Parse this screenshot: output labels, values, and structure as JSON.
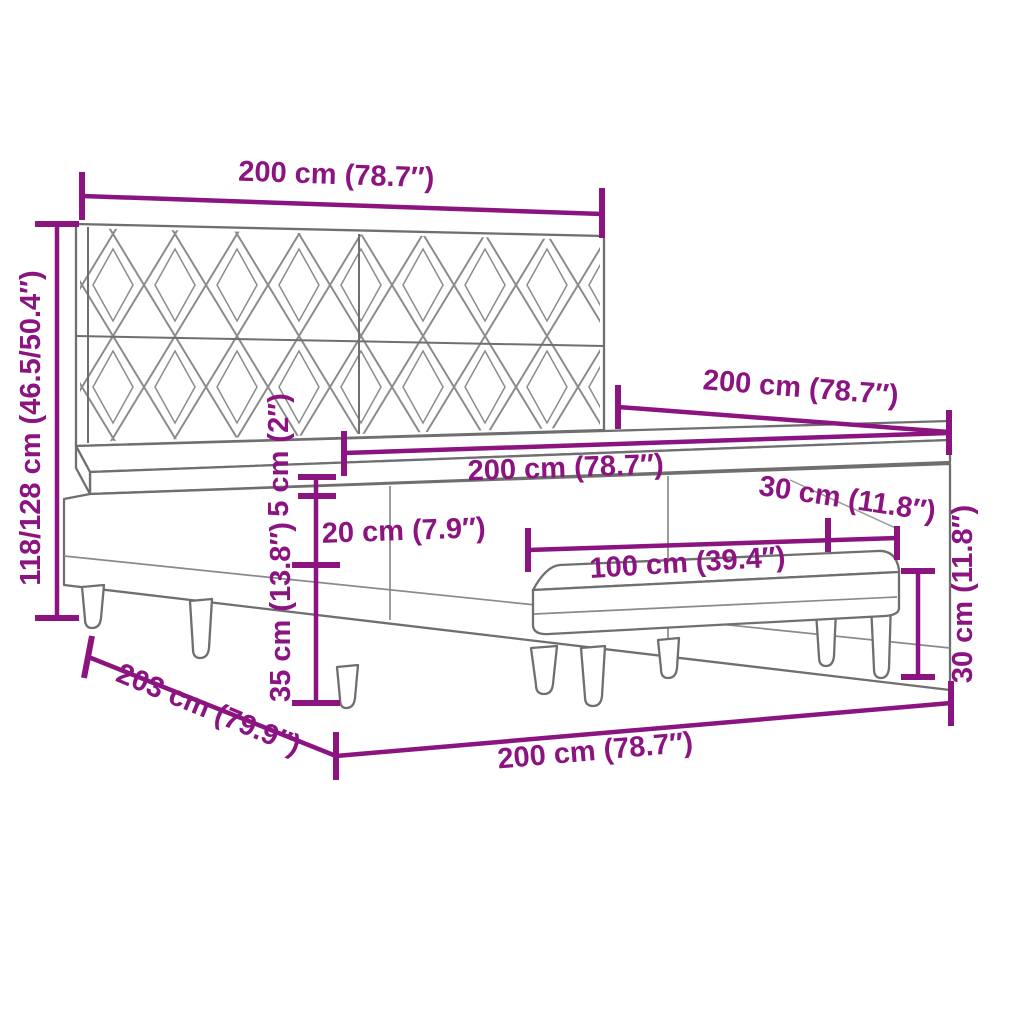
{
  "diagram": {
    "kind": "furniture-dimension-diagram",
    "subject": "box spring bed with patterned headboard and bench",
    "colors": {
      "dimension_accent": "#8B1480",
      "furniture_line": "#6F6F6F",
      "pattern_line": "#8B8B8B",
      "background": "#FFFFFF"
    },
    "dims": {
      "headboard_width": "200 cm (78.7″)",
      "bed_height": "118/128 cm (46.5/50.4″)",
      "bed_depth_top": "200 cm (78.7″)",
      "mattress_width": "200 cm (78.7″)",
      "mattress_top_height": "5 cm (2″)",
      "base_upper_height": "20 cm (7.9″)",
      "base_lower_height": "35 cm (13.8″)",
      "bench_length": "100 cm (39.4″)",
      "bench_depth": "30 cm (11.8″)",
      "bench_height": "30 cm (11.8″)",
      "bed_depth_bottom": "203 cm (79.9″)",
      "bed_width_bottom": "200 cm (78.7″)"
    }
  }
}
